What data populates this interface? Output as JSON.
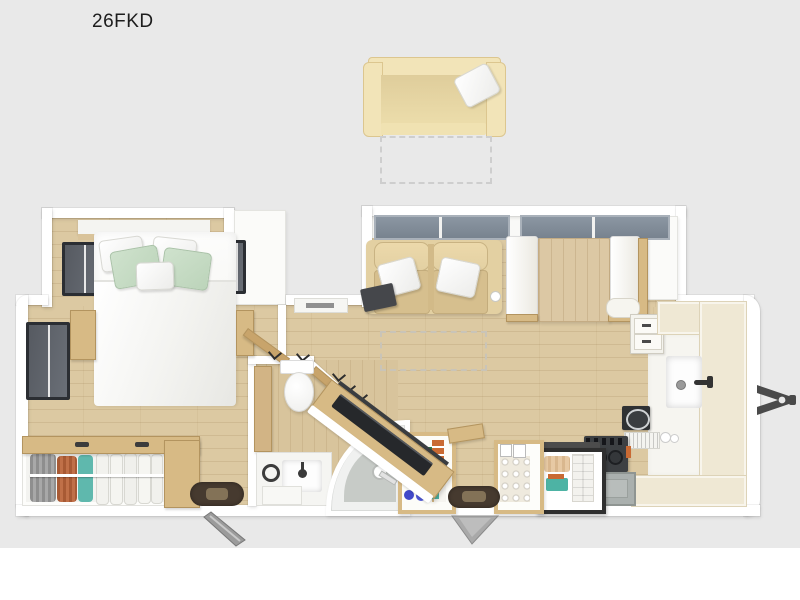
{
  "title": {
    "label": "26FKD"
  },
  "floorplan": {
    "type": "travel-trailer front-kitchen floor plan, top-down 3D render",
    "features": [
      "optional-sofa-above-plan",
      "sofa-slide-position-dashed-outline",
      "bedroom-slideout",
      "queen-bed",
      "mint-accent-pillows",
      "overhead-cabinet-above-bed",
      "nightstand-left",
      "nightstand-right",
      "bedroom-window-left",
      "bedroom-window-right",
      "rear-wall-window",
      "wardrobe-closet-with-hanging-clothes",
      "hall-closet-cabinet",
      "closet-door-swing",
      "hall-overhead-vent-cabinet",
      "bathroom",
      "toilet",
      "bathroom-vanity-sink",
      "corner-shower",
      "shower-head",
      "angled-tv-entertainment-cabinet",
      "tv",
      "pantry-with-food",
      "wood-side-shelf",
      "living-slideout",
      "theater-seating-two-recliners",
      "armrest-tray-table",
      "cup-holder",
      "living-window",
      "dinette-booth",
      "dinette-table",
      "dinette-window",
      "kitchen-corner-cabinet",
      "kitchen-drawers",
      "kitchen-counter",
      "kitchen-sink",
      "faucet",
      "range-cooktop",
      "oven",
      "microwave",
      "dish-rack",
      "canisters",
      "refrigerator-open-with-food",
      "spice-rack",
      "shoe-cubby-with-balls",
      "bedroom-entry-door",
      "bedroom-door-mat",
      "main-entry-door-step",
      "main-entry-mat",
      "a-frame-hitch"
    ]
  },
  "colors": {
    "background": "#e9e9e9",
    "page_margin": "#ffffff",
    "text": "#1d1d1d",
    "wall": "#ffffff",
    "floor_wood": "#dcc9a2",
    "floor_bath": "#d8c49c",
    "counter": "#efe8d4",
    "cabinet_wood": "#d7ba85",
    "cabinet_wood_dark": "#b3945f",
    "sofa": "#f2e4b8",
    "sofa_inner": "#dfcd9b",
    "seat": "#e3d0a2",
    "seat_dark": "#d6bf8e",
    "mint": "#cfe2cd",
    "window": "#78838f",
    "window_frame": "#a9b1ba",
    "window_dark": "#565a61",
    "tv": "#26282b",
    "stove": "#3d4043",
    "oven": "#aab0ae",
    "hitch": "#4a4a4a",
    "mat": "#463a2f",
    "mat_inner": "#837257",
    "step": "#a9a9a9",
    "accent_green": "#2f7a4a",
    "accent_orange": "#c96a33",
    "accent_blue": "#4149c9",
    "accent_teal": "#4db3a4"
  }
}
